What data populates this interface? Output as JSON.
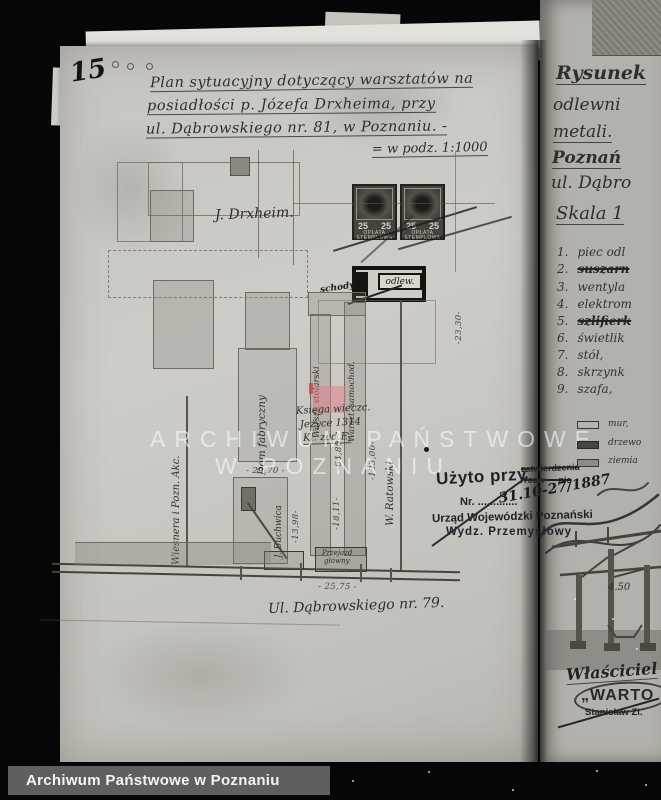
{
  "frame": {
    "archive_bar_label": "Archiwum Państwowe w Poznaniu"
  },
  "watermark": {
    "line1": "ARCHIWUM PAŃSTWOWE",
    "line2": "W POZNANIU"
  },
  "main_page": {
    "page_number": "15",
    "title": {
      "line1": "Plan sytuacyjny dotyczący warsztatów na",
      "line2": "posiadłości p. Józefa Drxheima, przy",
      "line3": "ul. Dąbrowskiego nr. 81, w Poznaniu. -",
      "scale_note": "= w podz. 1:1000"
    },
    "revenue_stamp": {
      "value_left": "25",
      "value_right": "25",
      "caption_line1": "OPŁATA",
      "caption_line2": "STEMPLOWA"
    },
    "plan_labels": {
      "neighbor_top": "J. Drxheim.",
      "foundry": "odlew.",
      "stairs": "schody",
      "building_left": "Dom fabryczny",
      "workshop_left": "Warszt. stolarski",
      "workshop_right": "Warszt. samochod.",
      "register_line1": "Księga wieczc.",
      "register_line2": "Jeżyce 1314",
      "register_line3": "Kl. zad E.",
      "neighbor_left_boundary": "Wiesnera i Pozn. Akc.",
      "neighbor_left_lower": "J. Buchwica",
      "neighbor_right": "W. Ratowski",
      "passage_line1": "Przejazd",
      "passage_line2": "główny",
      "street": "Ul. Dąbrowskiego nr. 79."
    },
    "dimensions": {
      "d1": "- 29,70 -",
      "d2": "- 25,75 -",
      "d3": "-133,00-",
      "d4": "-23,30-",
      "d5": "-18,11-",
      "d6": "-13,98-",
      "d7": "-64,80-"
    },
    "usage_stamp": {
      "used_at": "Użyto przy",
      "approval_word": "zatwierdzenia",
      "approval_word2": "rozw — nie",
      "nr_label": "Nr. .............",
      "office": "Urząd Wojewódzki Poznański",
      "department": "Wydz. Przemysłowy",
      "handwritten_ref": "31.10-27/1887"
    }
  },
  "right_page": {
    "header": {
      "line1": "Rysunek",
      "line2": "odlewni",
      "line3": "metali.",
      "line4": "Poznań",
      "line5": "ul. Dąbro"
    },
    "scale_label": "Skala 1",
    "equipment_list": [
      {
        "num": "1.",
        "text": "piec odl"
      },
      {
        "num": "2.",
        "text": "suszarn"
      },
      {
        "num": "3.",
        "text": "wentyla"
      },
      {
        "num": "4.",
        "text": "elektrom"
      },
      {
        "num": "5.",
        "text": "szlifierk"
      },
      {
        "num": "6.",
        "text": "świetlik"
      },
      {
        "num": "7.",
        "text": "stół,"
      },
      {
        "num": "8.",
        "text": "skrzynk"
      },
      {
        "num": "9.",
        "text": "szafa,"
      }
    ],
    "legend": {
      "item1": "mur,",
      "item2": "drzewo",
      "item3": "ziemia"
    },
    "section_dim": "4.50",
    "owner_block": {
      "owner": "Właściciel",
      "stamp_name": "„WARTO",
      "stamp_person": "Stanisław Zi."
    }
  }
}
